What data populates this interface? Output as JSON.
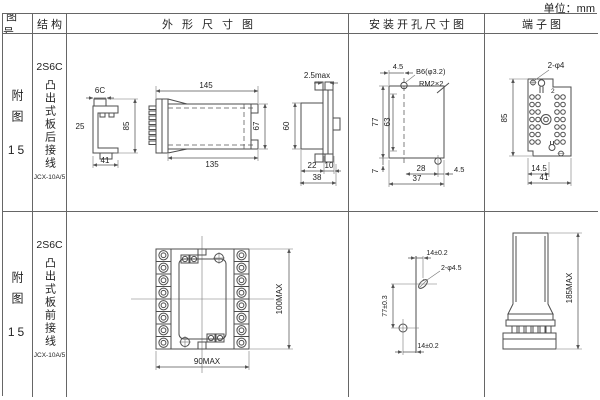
{
  "unit_label": "单位：mm",
  "headers": {
    "fig_no": "图号",
    "structure": "结构",
    "outline": "外形尺寸图",
    "install": "安装开孔尺寸图",
    "terminal": "端子图"
  },
  "rows": [
    {
      "fig_label": "附图",
      "fig_num": "15",
      "model": "2S6C",
      "desc": "凸出式板后接线",
      "code": "JCX-10A/5",
      "outline": {
        "v1_top": "6C",
        "v1_left": "25",
        "v1_right": "85",
        "v1_bottom": "41",
        "v2_top": "145",
        "v2_bottom": "135",
        "v2_right": "67",
        "v3_top": "2.5max",
        "v3_left": "60",
        "v3_b1": "22",
        "v3_b2": "10",
        "v3_b3": "38"
      },
      "install": {
        "top": "4.5",
        "hole_label": "B6(φ3.2)",
        "thread_label": "RM2×2",
        "h_outer": "77",
        "h_inner": "63",
        "b_left": "7",
        "b_inner": "28",
        "b_outer": "37",
        "b_right": "4.5"
      },
      "terminal": {
        "top": "2-φ4",
        "corner": "2",
        "left": "85",
        "b_inner": "14.5",
        "b_outer": "41"
      }
    },
    {
      "fig_label": "附图",
      "fig_num": "15",
      "model": "2S6C",
      "desc": "凸出式板前接线",
      "code": "JCX-10A/5",
      "outline": {
        "right": "100MAX",
        "bottom": "90MAX"
      },
      "install": {
        "top": "14±0.2",
        "hole_label": "2-φ4.5",
        "left": "77±0.3",
        "bottom": "14±0.2"
      },
      "terminal": {
        "right": "185MAX"
      }
    }
  ]
}
